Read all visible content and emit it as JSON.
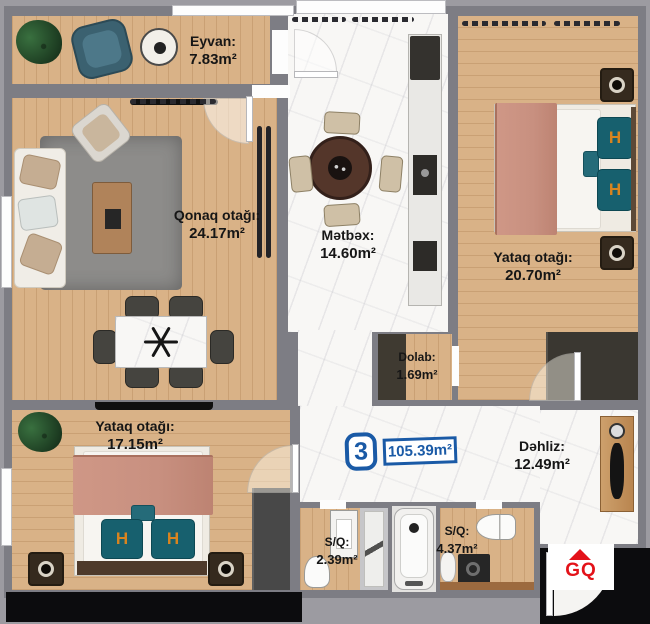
{
  "rooms": [
    {
      "key": "eyvan",
      "name": "Eyvan:",
      "area": "7.83m²"
    },
    {
      "key": "qonaq",
      "name": "Qonaq otağı:",
      "area": "24.17m²"
    },
    {
      "key": "metbex",
      "name": "Mətbəx:",
      "area": "14.60m²"
    },
    {
      "key": "yataq1",
      "name": "Yataq otağı:",
      "area": "20.70m²"
    },
    {
      "key": "dolab",
      "name": "Dolab:",
      "area": "1.69m²"
    },
    {
      "key": "yataq2",
      "name": "Yataq otağı:",
      "area": "17.15m²"
    },
    {
      "key": "dehliz",
      "name": "Dəhliz:",
      "area": "12.49m²"
    },
    {
      "key": "sq1",
      "name": "S/Q:",
      "area": "2.39m²"
    },
    {
      "key": "sq2",
      "name": "S/Q:",
      "area": "4.37m²"
    }
  ],
  "badge": {
    "number": "3",
    "total_area": "105.39m²"
  },
  "logo": {
    "text": "GQ"
  },
  "bed_monogram": "H",
  "colors": {
    "background": "#9c9ba1",
    "wall": "#7d7d84",
    "wood": "#d9b287",
    "marble": "#f8f7f5",
    "badge_blue": "#1a5aa6",
    "logo_red": "#e31219",
    "pillow_teal": "#17606e",
    "blanket_pink": "#c89080",
    "monogram_orange": "#d8841f"
  }
}
